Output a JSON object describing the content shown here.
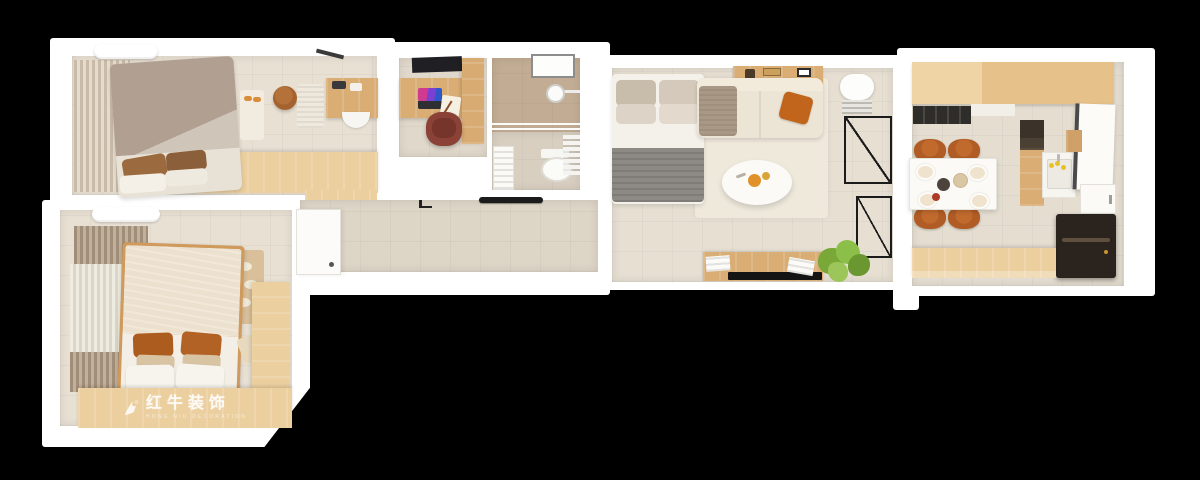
{
  "watermark": {
    "brand": "红牛装饰",
    "subtitle": "HONG NIU DECORATION",
    "logo_icon": "bull-swoosh-icon"
  },
  "palette": {
    "background": "#000000",
    "wall": "#ffffff",
    "wood": "#eccf9f",
    "wood_dark": "#d9ad74",
    "floor": "#e8e0d3",
    "floor_cool": "#ddd5c6",
    "shower_tile": "#c2ad94",
    "duvet_taupe": "#b1a092",
    "duvet_cream": "#ece1ce",
    "blanket_gray": "#8d8a86",
    "accent_orange": "#c2651c",
    "pillow_rust": "#ad5c20",
    "chair_leather": "#b05c24",
    "chair_office": "#8c4136",
    "dark_cabinet": "#2b231d",
    "plant": "#79a839"
  }
}
